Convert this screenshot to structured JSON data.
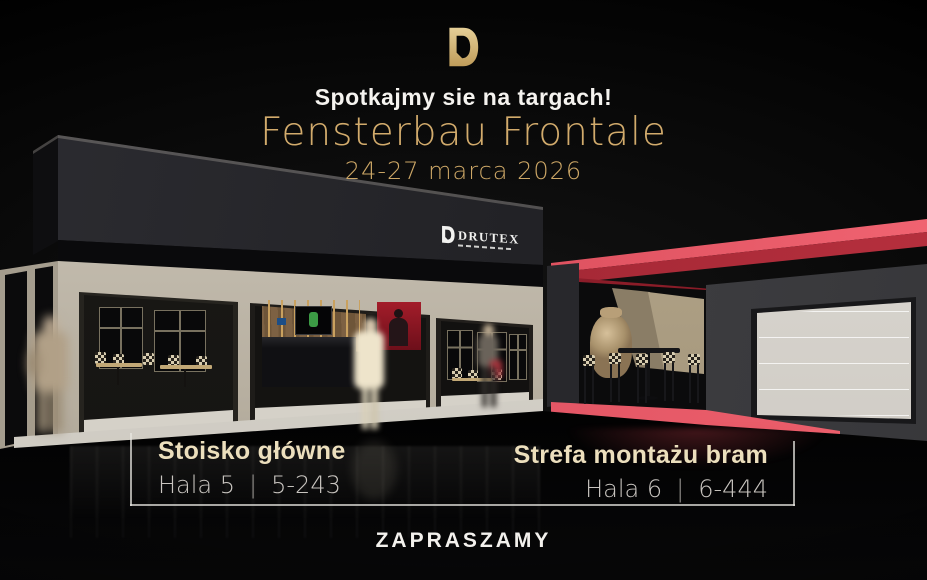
{
  "header": {
    "kicker": "Spotkajmy sie na targach!",
    "title": "Fensterbau Frontale",
    "dates": "24-27 marca 2026"
  },
  "brand": {
    "name": "DRUTEX",
    "logo_icon": "drutex-d-logo",
    "logo_gold": "#d6b679"
  },
  "stands": {
    "left": {
      "title": "Stoisko główne",
      "hall": "Hala 5",
      "separator": "|",
      "number": "5-243"
    },
    "right": {
      "title": "Strefa montażu bram",
      "hall": "Hala 6",
      "separator": "|",
      "number": "6-444"
    }
  },
  "footer": {
    "cta": "ZAPRASZAMY"
  },
  "colors": {
    "accent_gold": "#d2ab6c",
    "accent_red": "#e25563",
    "booth_dark": "#222226",
    "wall_beige": "#c9c3b6",
    "garage_door": "#d9d6d0"
  }
}
